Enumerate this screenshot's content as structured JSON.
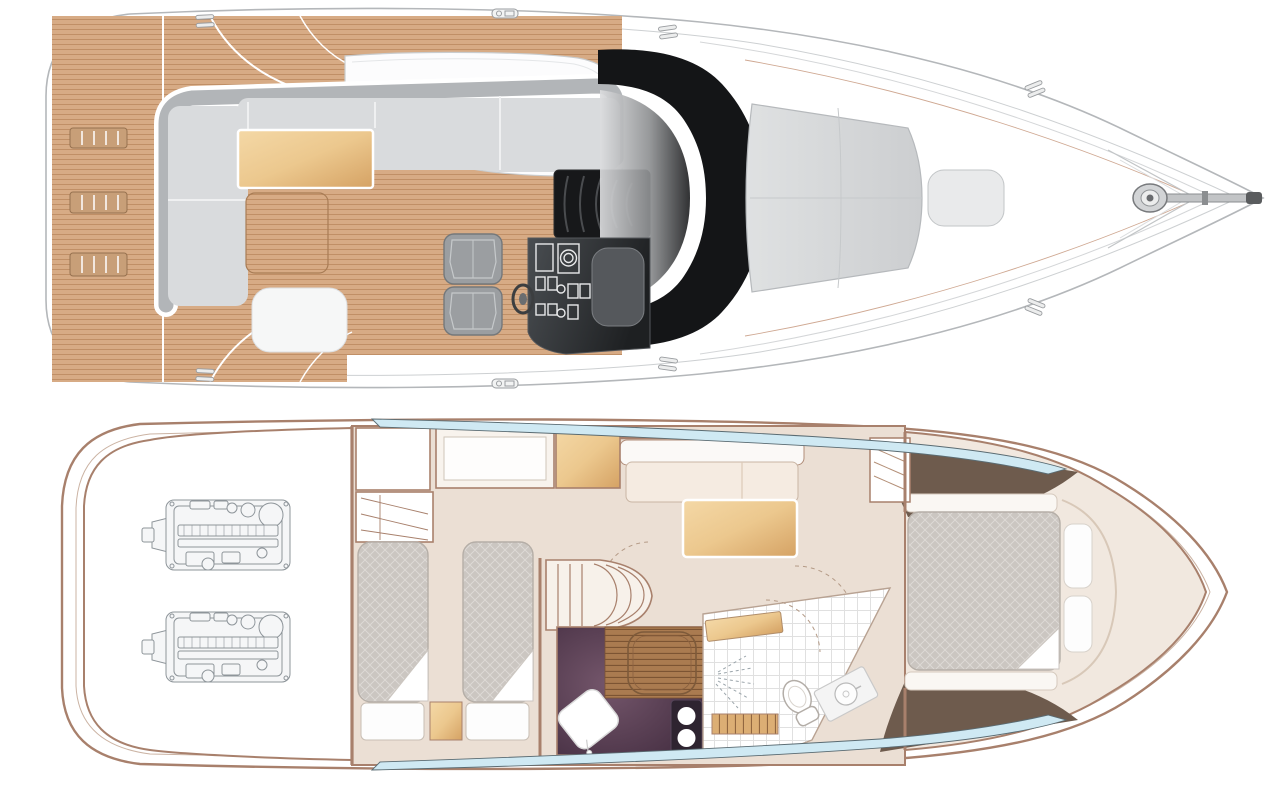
{
  "diagram": {
    "type": "yacht-deck-plan",
    "views": [
      {
        "id": "main-deck",
        "label": "Main deck and exterior plan view"
      },
      {
        "id": "lower-deck",
        "label": "Lower deck accommodation plan view"
      }
    ],
    "areas": {
      "main_deck": "Main deck and exterior",
      "swim_platform": "Teak swim platform",
      "deck_vent": "Deck vent grate",
      "cockpit_seating": "Cockpit wrap-around seating",
      "cockpit_table": "Cockpit table",
      "teak_floor_panel": "Teak cockpit floor panel",
      "sunbed_base": "Sunbed base",
      "coachroof": "Coachroof",
      "forward_dinette": "Forward cockpit seating",
      "helm_seat": "Helm seat",
      "steering_wheel": "Steering wheel",
      "helm_console": "Helm console with instruments",
      "companionway_stairs": "Companionway stairs to lower deck",
      "windscreen_arch": "Windscreen and arch",
      "foredeck": "Foredeck",
      "sun_pad": "Foredeck sun pad",
      "sun_pad_bolster": "Sun pad bolster",
      "anchor_windlass": "Anchor windlass",
      "bow_pulpit": "Bow pulpit",
      "cleat": "Mooring cleat",
      "deck_fitting": "Deck fitting",
      "lower_deck": "Lower deck accommodation",
      "engine_room": "Engine room",
      "engine": "Engine",
      "twin_cabin": "Twin guest cabin",
      "twin_bed": "Single berth",
      "bed_sheet": "Turned-down sheet",
      "nightstand": "Night stand",
      "wardrobe": "Wardrobe with hangers",
      "cabinet": "Cabinet",
      "shelf_unit": "Shelf unit",
      "stairwell": "Curved staircase from main deck",
      "galley": "Galley worktop",
      "galley_sink": "Galley sink",
      "galley_hob": "Two-burner hob",
      "dinette_floor": "Wood floor with dinette table",
      "saloon": "Saloon",
      "saloon_sofa": "Saloon sofa",
      "saloon_table": "Saloon table",
      "bathroom": "Bathroom",
      "shower": "Shower",
      "toilet": "Toilet",
      "wash_basin": "Wash basin",
      "vanity": "Vanity unit",
      "bath_steps": "Steps",
      "master_cabin": "Forward master cabin",
      "master_bed": "Double island berth",
      "pillow": "Pillow",
      "side_bench": "Side bench",
      "hull_window": "Hull window",
      "door_swing": "Door swing",
      "hull": "Hull outline"
    }
  },
  "palette": {
    "background": "#ffffff",
    "teak": "#d7ab85",
    "teak_line": "#bd8b61",
    "seat_back": "#b2b5b8",
    "cushion": "#d9dbdd",
    "table_tan_light": "#f4d8a6",
    "table_tan_dark": "#d5a264",
    "dark_windscreen": "#141517",
    "hull_line": "#b4b7ba",
    "lower_wall": "#a8806c",
    "floor_cream": "#ebdfd4",
    "bed_gray": "#cbc6c1",
    "galley_purple_dark": "#3c273a",
    "galley_purple_light": "#74566b",
    "wood_floor": "#aa7b50",
    "wood_floor_line": "#7c5433",
    "window_blue": "#cfe9f3",
    "wedge_taupe": "#6e5b4d",
    "engine_line": "#8e959a"
  }
}
